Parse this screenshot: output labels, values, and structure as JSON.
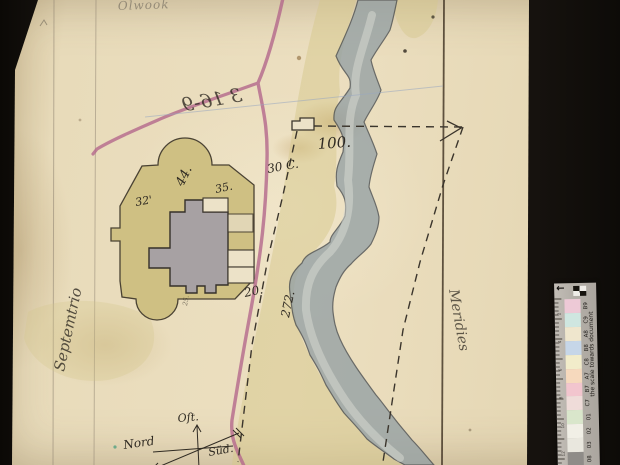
{
  "map": {
    "annotations": {
      "top_note": "Olwook",
      "reverse_note": "3 16-9",
      "left_margin": "Septemtrio",
      "right_margin": "Meridies"
    },
    "dimensions": {
      "d100": "100.",
      "d44": "44.",
      "d35": "35.",
      "d32": "32'",
      "d30c": "30 C.",
      "d20": "20.",
      "d272": "272.",
      "d25": "25."
    },
    "compass": {
      "east": "Oſt.",
      "north": "Nord",
      "south": "Süd."
    },
    "colors": {
      "paper": "#e9dcbd",
      "road_pink": "#b4688c",
      "river_gray": "#94a0a4",
      "river_highlight": "#d9dcd4",
      "land_wash": "#d5c78b",
      "enclosure_khaki": "#cfc083",
      "building_gray": "#a7a1a3",
      "annex_white": "#ece2c8",
      "ink": "#2f2a22",
      "reverse_note_blue": "#8fa0c8",
      "margin_ink_brown": "#8a5a2e"
    }
  },
  "scale_bar": {
    "caption": "the scale towards document",
    "icons": {
      "registration_arrow": "←"
    },
    "ruler_numbers": [
      "2",
      "4",
      "6",
      "8",
      "10",
      "12"
    ],
    "patches": [
      {
        "label": "B9",
        "style": "background:#edc9d6"
      },
      {
        "label": "C9",
        "style": "background:#cfe6e0"
      },
      {
        "label": "A8",
        "style": "background:#efe6cd"
      },
      {
        "label": "B8",
        "style": "background:#c6d6e8"
      },
      {
        "label": "C8",
        "style": "background:#f2ecca"
      },
      {
        "label": "A7",
        "style": "background:#f6d9bd"
      },
      {
        "label": "B7",
        "style": "background:#f2c5ce"
      },
      {
        "label": "C7",
        "style": "background:#efdcd9"
      },
      {
        "label": "01",
        "style": "background:#d9e6cb"
      },
      {
        "label": "02",
        "style": "background:#f1efe6"
      },
      {
        "label": "03",
        "style": "background:#e9e7de"
      },
      {
        "label": "08",
        "style": "background:#8f8c88"
      }
    ]
  }
}
